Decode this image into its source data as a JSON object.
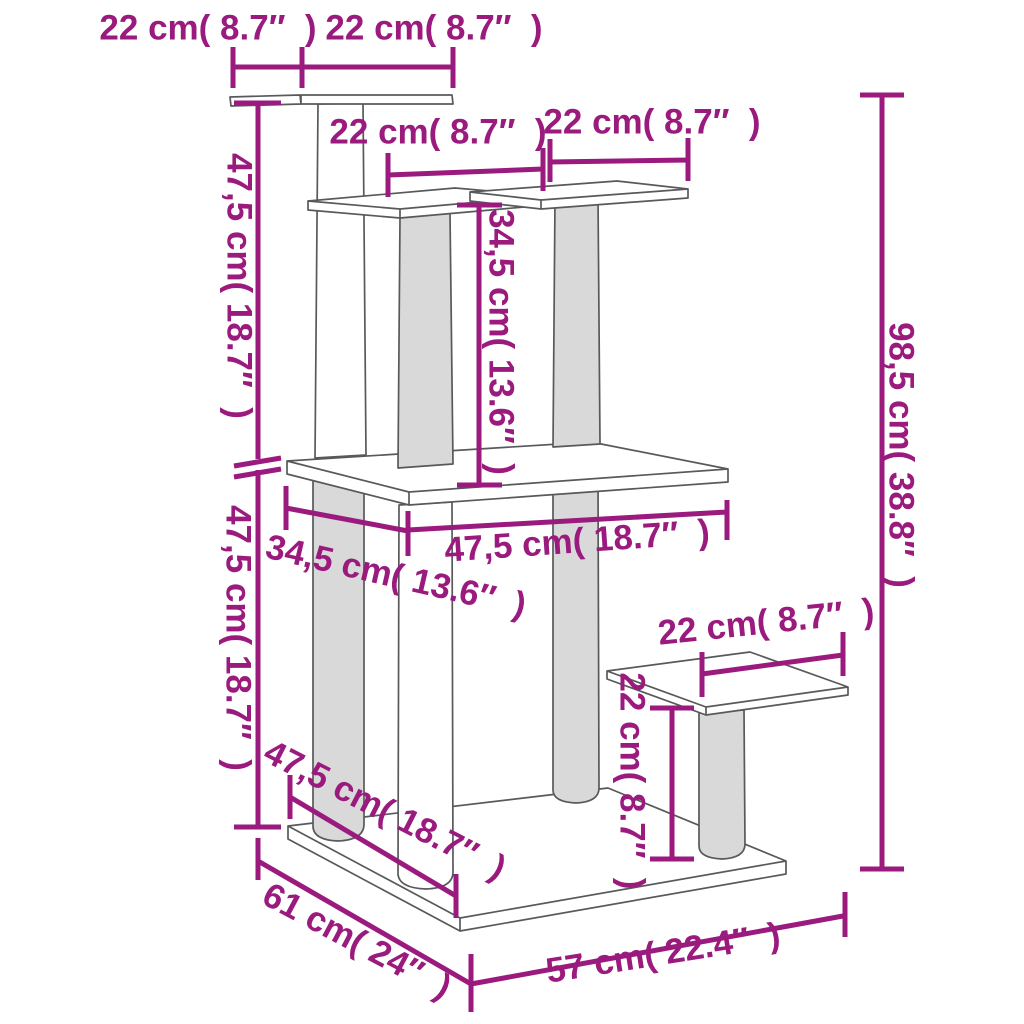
{
  "diagram": {
    "kind": "product-dimension-diagram",
    "subject": "cat tree with scratching posts and platforms",
    "accent_color": "#9A1A7E",
    "sketch_color": "#58595B",
    "unit_labels": {
      "top_platform_depth": "22 cm( 8.7″  )",
      "top_platform_width": "22 cm( 8.7″  )",
      "upper_section_height": "47,5 cm( 18.7″  )",
      "mid_board_width": "22 cm( 8.7″  )",
      "upper_right_board_width": "22 cm( 8.7″  )",
      "middle_post_height": "34,5 cm( 13.6″  )",
      "total_height": "98,5 cm( 38.8″  )",
      "lower_section_height": "47,5 cm( 18.7″  )",
      "middle_platform_width": "47,5 cm( 18.7″  )",
      "middle_platform_depth": "34,5 cm( 13.6″  )",
      "step_platform_width": "22 cm( 8.7″  )",
      "step_post_height": "22 cm( 8.7″  )",
      "base_inner_depth": "47,5 cm( 18.7″  )",
      "base_depth": "61 cm( 24″  )",
      "base_width": "57 cm( 22.4″  )"
    }
  }
}
